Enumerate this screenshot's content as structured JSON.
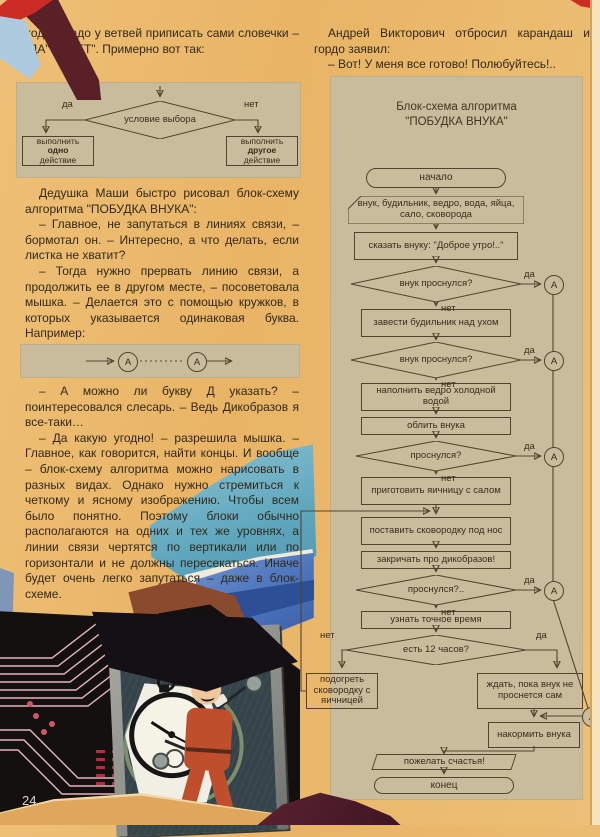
{
  "page": {
    "number": "24"
  },
  "left_column": {
    "p1": "ходах, надо у ветвей приписать сами словечки – \"ДА\" и \"НЕТ\". Примерно вот так:",
    "p2": "Дедушка Маши быстро рисовал блок-схему алгоритма \"ПОБУДКА ВНУКА\":",
    "p3": "– Главное, не запутаться в линиях связи, – бормотал он. – Интересно, а что делать, если листка не хватит?",
    "p4": "– Тогда нужно прервать линию связи, а продолжить ее в другом месте, – посоветовала мышка. – Делается это с помощью кружков, в которых указывается одинаковая буква. Например:",
    "p5": "– А можно ли букву Д указать? – поинтересовался слесарь. – Ведь Дикобразов я все-таки…",
    "p6": "– Да какую угодно! – разрешила мышка. – Главное, как говорится, найти концы. И вообще – блок-схему алгоритма можно нарисовать в разных видах. Однако нужно стремиться к четкому и ясному изображению. Чтобы всем было понятно. Поэтому блоки обычно располагаются на одних и тех же уровнях, а линии связи чертятся по вертикали или по горизонтали и не должны пересекаться. Иначе будет очень легко запутаться – даже в блок-схеме."
  },
  "right_column": {
    "p1": "Андрей Викторович отбросил карандаш и гордо заявил:",
    "p2": "– Вот! У меня все готово! Полюбуйтесь!.."
  },
  "intro_diagram": {
    "condition": "условие выбора",
    "yes": "да",
    "no": "нет",
    "left_box": {
      "l1": "выполнить",
      "l2": "одно",
      "l3": "действие"
    },
    "right_box": {
      "l1": "выполнить",
      "l2": "другое",
      "l3": "действие"
    }
  },
  "connector_diagram": {
    "label": "А"
  },
  "flowchart": {
    "title_line1": "Блок-схема алгоритма",
    "title_line2": "\"ПОБУДКА ВНУКА\"",
    "yes": "да",
    "no": "нет",
    "connector": "А",
    "nodes": [
      {
        "type": "terminal",
        "text": "начало"
      },
      {
        "type": "data",
        "text": "внук, будильник, ведро, вода, яйца, сало, сковорода"
      },
      {
        "type": "process",
        "text": "сказать внуку: \"Доброе утро!..\""
      },
      {
        "type": "decision",
        "text": "внук проснулся?"
      },
      {
        "type": "process",
        "text": "завести будильник над ухом"
      },
      {
        "type": "decision",
        "text": "внук проснулся?"
      },
      {
        "type": "process",
        "text": "наполнить ведро холодной водой"
      },
      {
        "type": "process",
        "text": "облить внука"
      },
      {
        "type": "decision",
        "text": "проснулся?"
      },
      {
        "type": "process",
        "text": "приготовить яичницу с салом"
      },
      {
        "type": "process",
        "text": "поставить сковородку под нос"
      },
      {
        "type": "process",
        "text": "закричать про дикобразов!"
      },
      {
        "type": "decision",
        "text": "проснулся?.."
      },
      {
        "type": "process",
        "text": "узнать точное время"
      },
      {
        "type": "decision",
        "text": "есть 12 часов?"
      },
      {
        "type": "process",
        "text": "подогреть сковородку с яичницей"
      },
      {
        "type": "process",
        "text": "ждать, пока внук не проснется сам"
      },
      {
        "type": "process",
        "text": "накормить внука"
      },
      {
        "type": "io",
        "text": "пожелать счастья!"
      },
      {
        "type": "terminal",
        "text": "конец"
      }
    ]
  }
}
